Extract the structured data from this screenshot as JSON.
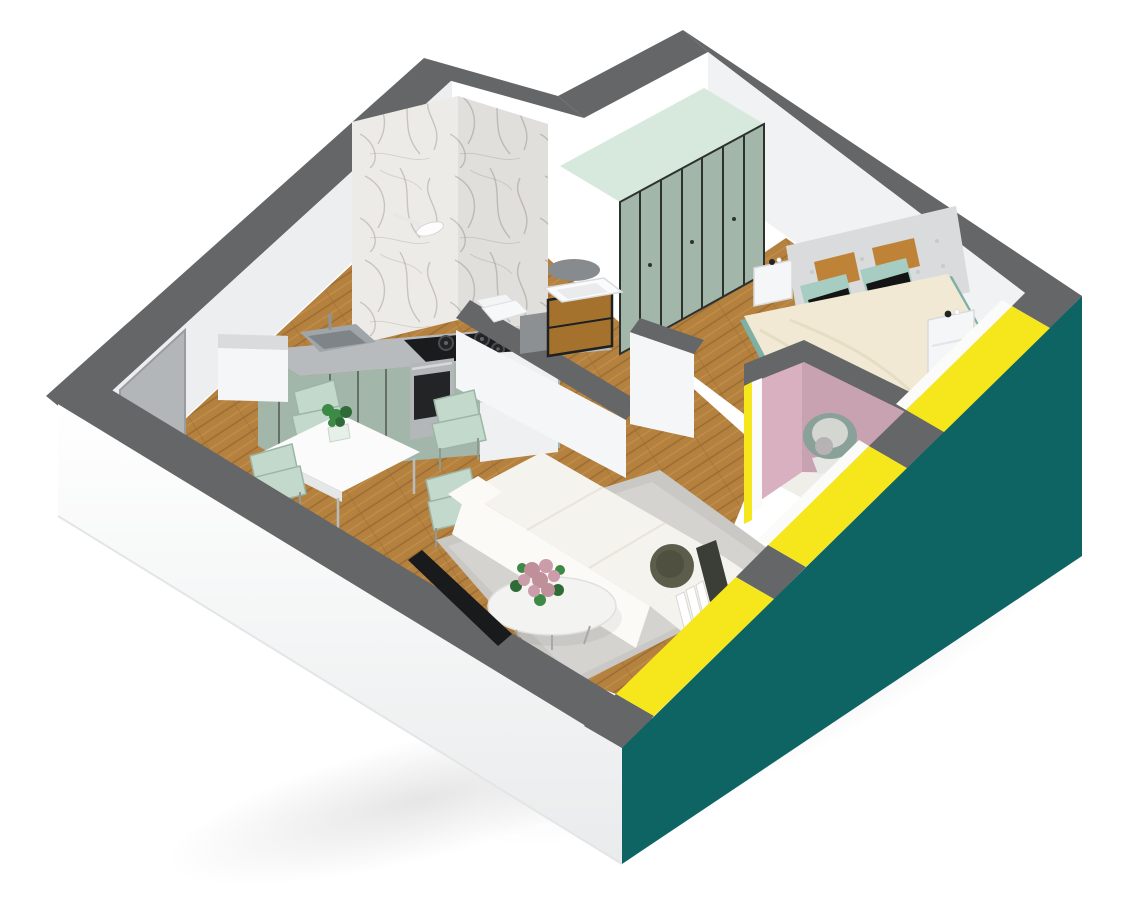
{
  "scene": {
    "type": "3d-isometric-floor-plan",
    "description": "Cutaway 3D render of a one-bedroom apartment viewed from above",
    "rooms": [
      {
        "name": "kitchen",
        "furniture": [
          "counter",
          "sink",
          "gas-hob",
          "oven",
          "fridge",
          "sage-cabinets",
          "marble-backsplash"
        ]
      },
      {
        "name": "dining-area",
        "furniture": [
          "white-table",
          "four-mint-chairs",
          "potted-plant"
        ]
      },
      {
        "name": "living-room",
        "furniture": [
          "white-corner-sofa",
          "round-coffee-table",
          "flower-bouquet",
          "gray-rug",
          "tv"
        ]
      },
      {
        "name": "bathroom",
        "furniture": [
          "shower-fixture",
          "wood-vanity",
          "washbasin",
          "mirror",
          "toilet",
          "washer"
        ]
      },
      {
        "name": "hallway",
        "furniture": [
          "sage-wardrobe"
        ]
      },
      {
        "name": "bedroom",
        "furniture": [
          "double-bed",
          "tufted-headboard",
          "two-nightstands",
          "pillows"
        ]
      },
      {
        "name": "balcony",
        "furniture": [
          "round-papasan-chair"
        ]
      }
    ]
  },
  "colors": {
    "bg": "#ffffff",
    "cap": "#646668",
    "cap_light": "#75777a",
    "wall_face": "#eceeef",
    "wall_face2": "#f1f2f3",
    "wall_white": "#f4f6f7",
    "ext_white": "#f7f8f9",
    "ext_white_deep": "#e9ebec",
    "teal": "#0d6462",
    "yellow": "#f6e71d",
    "sill_white": "#fbfcfa",
    "door_gray": "#b3b6b8",
    "door_gray_dark": "#9a9da0",
    "marble_base": "#edebe7",
    "marble_vein": "#a9a49c",
    "wood_base": "#b5813f",
    "wood_dark": "#9c6c32",
    "wood_light": "#c49150",
    "sage": "#a2b6aa",
    "sage_dark": "#2e322f",
    "mint_top": "#d7e9dc",
    "counter": "#b8bbbd",
    "steel": "#9fa5a8",
    "steel_dark": "#7e8487",
    "hob_black": "#1a1b1d",
    "burner": "#222426",
    "burner_rim": "#4a4d4f",
    "oven_steel": "#b4b7b9",
    "oven_glass": "#232425",
    "fridge": "#eef0f1",
    "chair_mint": "#c3d9cc",
    "chair_mint_dark": "#9db5a7",
    "table_white": "#fafbfa",
    "table_edge": "#e4e6e7",
    "plant_green": "#3c8a46",
    "plant_green_dark": "#2e6b36",
    "rug": "#c9c8c4",
    "rug_light": "#d4d3cf",
    "sofa": "#f5f3ed",
    "sofa_bright": "#fbfaf6",
    "sofa_shade": "#efece3",
    "olive": "#5c5d4b",
    "olive_dark": "#4f5040",
    "pillow_dark": "#3a3e36",
    "tv_black": "#191a1c",
    "tabletop": "#f3f3f1",
    "flower_pink": "#bf8f9a",
    "flower_pink2": "#cb9daa",
    "pink_wall": "#d8b0c0",
    "pink_wall_dark": "#c9a2b2",
    "balcony_floor": "#efeee9",
    "papasan": "#8aa19a",
    "papasan_cushion": "#d4d6d2",
    "blanket": "#b7b2b4",
    "headboard": "#dadbdd",
    "tuft": "#c9cacc",
    "duvet": "#f1e9d3",
    "duvet_shade": "#e3d9c2",
    "mustard": "#bf8338",
    "pillow_mint": "#a7cdc2",
    "pillow_black": "#141414",
    "nightstand": "#f5f6f7",
    "nightstand_shade": "#d8dadb",
    "bedframe_teal": "#7fb0a6",
    "vanity_wood": "#a5722e",
    "vanity_dark": "#1f2022",
    "mirror": "#888b8d",
    "washer": "#8d9093",
    "white": "#ffffff",
    "shadow": "#000000"
  }
}
